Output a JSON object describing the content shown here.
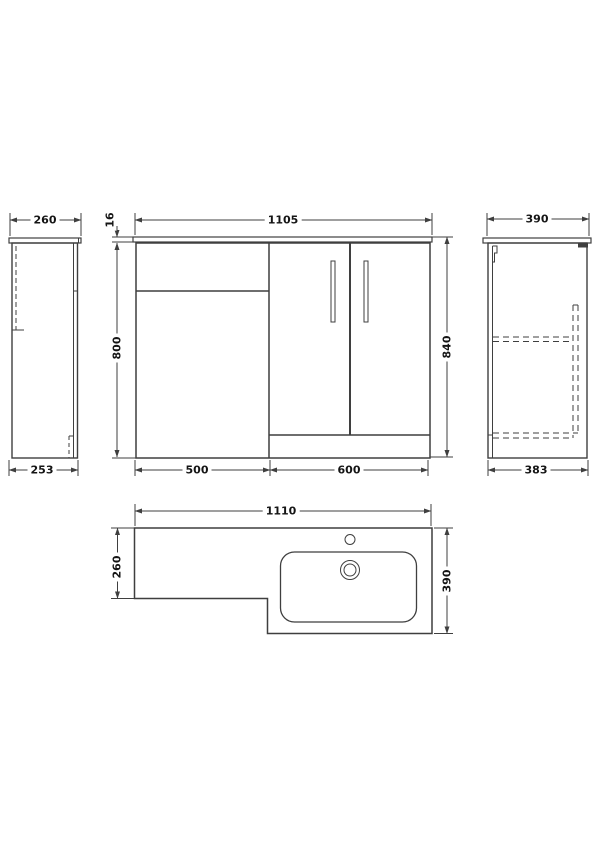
{
  "drawing": {
    "type": "technical-dimension-drawing",
    "subject": "L-shaped bathroom vanity combination unit (WC unit + basin unit)",
    "units": "mm",
    "colors": {
      "background": "#ffffff",
      "line": "#3f3f3f",
      "text": "#141414"
    },
    "views": {
      "left_side": {
        "label": "left side elevation",
        "width_top": "260",
        "width_bottom": "253"
      },
      "front": {
        "label": "front elevation",
        "overall_width": "1105",
        "worktop_thickness": "16",
        "cabinet_height": "800",
        "overall_height": "840",
        "left_unit_width": "500",
        "right_unit_width": "600"
      },
      "right_side": {
        "label": "right side elevation",
        "depth_top": "390",
        "depth_bottom": "383"
      },
      "plan": {
        "label": "plan view of worktop and basin",
        "overall_width": "1110",
        "left_depth": "260",
        "right_depth": "390"
      }
    },
    "features": {
      "icons": [
        "tap-hole-icon",
        "basin-waste-icon",
        "hinge-icon",
        "door-handle-icon"
      ]
    }
  }
}
